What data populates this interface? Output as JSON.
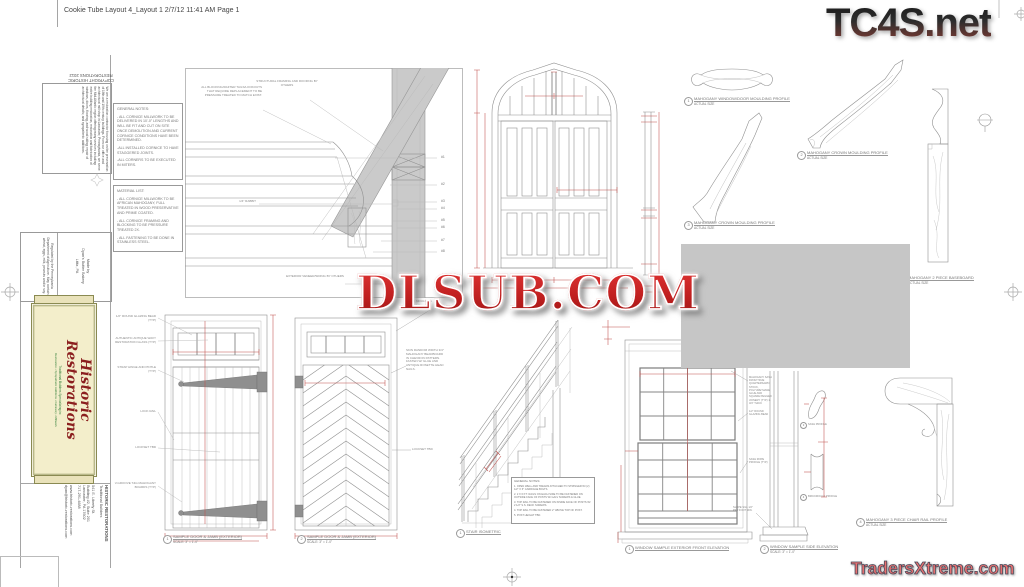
{
  "page": {
    "header": "Cookie Tube Layout 4_Layout 1  2/7/12  11:41 AM  Page 1",
    "watermark_top_right": "TC4S.net",
    "watermark_center": "DLSUB.COM",
    "watermark_bottom_right": "TradersXtreme.com",
    "colors": {
      "dim_red": "#c0504d",
      "line_gray": "#909090",
      "fill_gray": "#c6c6c6",
      "label_cream": "#f3eecb",
      "label_olive": "#8a8a52",
      "logo_red": "#8b1f1f",
      "logo_green": "#2f7d36",
      "watermark_red": "#c02020"
    }
  },
  "label_strip": {
    "copyright_line1": "COPYRIGHT HISTORIC",
    "copyright_line2": "RESTORATIONS 2012",
    "about": "We are a restoration contractor focusing on the preservation of 18th and 19th century buildings. From our office and architectural mill shop in Lancaster, Pennsylvania, we serve the Mid-Atlantic region offering many services including: entire building restoration, restoration and fabrication of windows, doors, flooring, and wood siding; repair of architectural details; and sympathetic additions.",
    "made_by_1": "Made by",
    "made_by_2": "Dyan's Butter Bakery",
    "made_by_3": "Lititz, PA",
    "regulated": "Regulated by the Pennsylvania Department of Agriculture. May contain wheat, eggs, milk, peanuts and/or soy.",
    "logo_name": "Historic Restorations",
    "logo_tag1": "Traditional Builders Specializing in:",
    "logo_tag2": "Restoration • Sympathetic Additions • Cabinetry • Millwork",
    "contact_company": "HISTORIC RESTORATIONS",
    "contact_type": "Traditional Builders",
    "contact_addr1": "541 E. Liberty St.",
    "contact_addr2": "Building #2, Suite 201",
    "contact_addr3": "Lancaster, PA 17602",
    "contact_phone": "717-291-4688",
    "contact_web": "www.historic-restorations.com",
    "contact_email": "dyan@historic-restorations.com"
  },
  "notes_general": {
    "title": "GENERAL NOTES:",
    "items": [
      "- ALL CORNICE MILLWORK TO BE DELIVERED IN 10'-0\" LENGTHS AND WILL BE FIT AND CUT ON SITE ONCE DEMOLITION AND CURRENT CORNICE CONDITIONS HAVE BEEN DETERMINED.",
      "-ALL INSTALLED CORNICE TO HAVE STAGGERED JOINTS.",
      "-ALL CORNERS TO BE EXECUTED IN MITERS."
    ]
  },
  "material_list": {
    "title": "MATERIAL LIST:",
    "items": [
      "- ALL CORNICE MILLWORK TO BE AFRICAN MAHOGANY, FULL TREATED IN WOOD PRESERVATIVE AND PRIME COATED.",
      "- ALL CORNICE FRAMING AND BLOCKING TO BE PRESSURE TREATED 2X.",
      "- ALL FASTENING TO BE DONE IN STAINLESS STEEL."
    ]
  },
  "cornice": {
    "note_structural": "STRUCTURAL FRAMING AND ROOFING BY OTHERS",
    "note_blocking": "ALL BLOCKING/RAFTER TAILS/LOOKOUTS THAT REQUIRE REPLACEMENT TO BE PRESSURE TREATED TO MATCH EXIST.",
    "note_rabbit": "1/4\" RABBIT",
    "note_veneer": "EXTERIOR VENEER/SIDING BY OTHERS",
    "callouts": [
      "#1",
      "#2",
      "#3",
      "#4",
      "#5",
      "#6",
      "#7",
      "#8"
    ]
  },
  "profiles": {
    "p1": {
      "num": "1",
      "title": "MAHOGANY WINDOW/DOOR MOULDING PROFILE",
      "sub": "ACTUAL SIZE"
    },
    "p2": {
      "num": "2",
      "title": "MAHOGANY CROWN MOULDING PROFILE",
      "sub": "ACTUAL SIZE"
    },
    "p3": {
      "num": "3",
      "title": "MAHOGANY CROWN MOULDING PROFILE",
      "sub": "ACTUAL SIZE"
    },
    "baseboard": {
      "title": "MAHOGANY 2 PIECE BASEBOARD",
      "sub": "ACTUAL SIZE"
    },
    "chair": {
      "num": "4",
      "title": "MAHOGANY 3 PIECE CHAIR RAIL PROFILE",
      "sub": "ACTUAL SIZE"
    }
  },
  "door1": {
    "num": "1",
    "title": "SAMPLE DOOR & JAMB (EXTERIOR)",
    "scale": "SCALE: 3\" = 1'-0\"",
    "notes": [
      "1/2\" ROUND GLAZING BEAD (TYP)",
      "AUTHENTIC ANTIQUE WAVY RESTORATION GLASS (TYP)",
      "STRAP HINGE AND PINTLE (TYP)",
      "LOCK RAIL",
      "LOCKSET TBD",
      "V-GROOVE T&G MAHOGANY BOARDS (TYP)"
    ]
  },
  "door2": {
    "num": "2",
    "title": "SAMPLE DOOR & JAMB (EXTERIOR)",
    "scale": "SCALE: 3\" = 1'-0\"",
    "note_brick_1": "BRICK MOULDING",
    "note_brick_2": "SEE 4/2-2",
    "note_skin": "SKIN RANDOM WIDTH 3/4\" MAHOGANY BEADBOARD IN CHEVRON PATTERN. FASTEN W/ GLUE AND ANTIQUE ROSETTE HEAD NAILS.",
    "note_lockset": "LOCKSET TBD"
  },
  "stair": {
    "num": "1",
    "title": "STAIR ISOMETRIC",
    "notes_title": "GENERAL NOTES:",
    "notes": [
      "1. OPEN WELL AND TREADS ATTACHED TO STRINGER W/ (2) 1/2\" X 6\" CARRIAGE BOLTS.",
      "2. 2 X 6 P.T. RAILS ON EACH SIDE TO BE FASTENED ON OUTSIDE FACE OF POSTS W/ GALV SCREWS & GLUE.",
      "3. TOP RAIL TO BE FASTENED ON INSIDE FACE OF POSTS W/ 2 1/2\" S.S. DECK SCREWS.",
      "4. TOP RAIL TO BE FASTENED 2\" ABOVE TOP OF POST.",
      "5. POST HEIGHT TBD."
    ]
  },
  "window": {
    "front_num": "1",
    "front_title": "WINDOW SAMPLE EXTERIOR FRONT ELEVATION",
    "side_num": "2",
    "side_title": "WINDOW SAMPLE SIDE ELEVATION",
    "side_scale": "SCALE: 3\" = 1'-0\"",
    "note_sash": "MAHOGANY SASH FROM TRUE QUARTERSAWN STOCK, POLYURETHANE GLUE AND SQUARE PEGGED JOINERY (TYP) 1-3/4\" THICK",
    "note_bead": "1/2\" ROUND GLAZING BEAD",
    "note_rope": "SASH ROPE PROFILE (TYP)",
    "note_sill": "SLOPE SILL 1/2\" PER FOOT MIN.",
    "mini1_num": "3",
    "mini1_label": "SASH PROFILE",
    "mini2_num": "4",
    "mini2_label": "BRICKMOULD PROFILE"
  }
}
